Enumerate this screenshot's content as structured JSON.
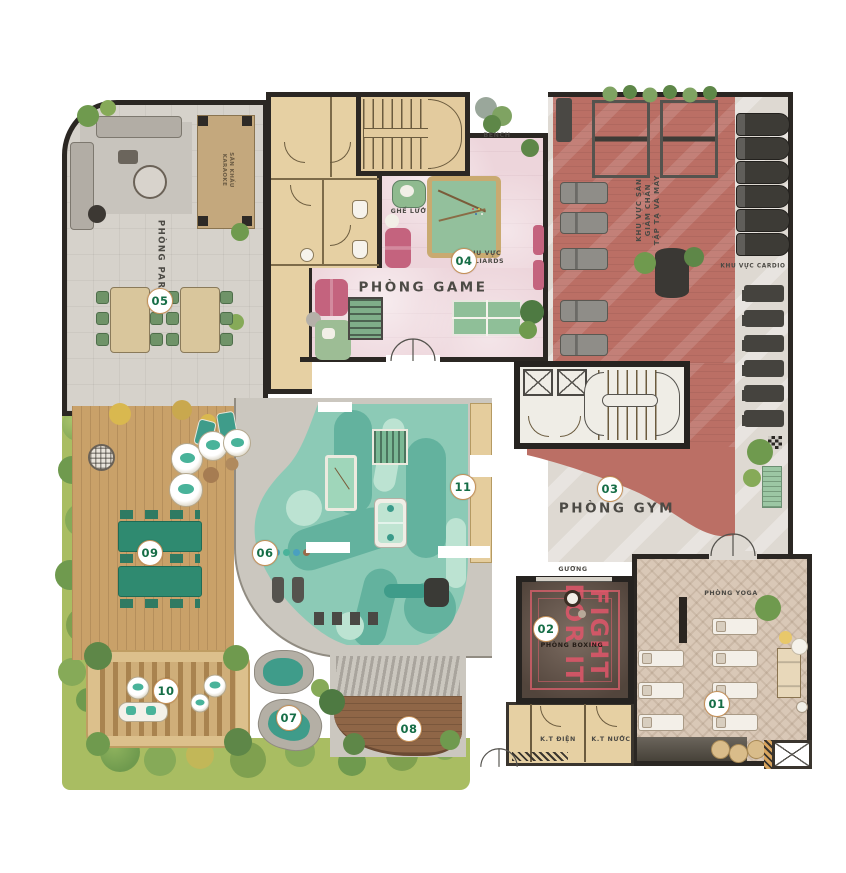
{
  "plan": {
    "markers": [
      {
        "id": "m01",
        "label": "01"
      },
      {
        "id": "m02",
        "label": "02"
      },
      {
        "id": "m03",
        "label": "03"
      },
      {
        "id": "m04",
        "label": "04"
      },
      {
        "id": "m05",
        "label": "05"
      },
      {
        "id": "m06",
        "label": "06"
      },
      {
        "id": "m07",
        "label": "07"
      },
      {
        "id": "m08",
        "label": "08"
      },
      {
        "id": "m09",
        "label": "09"
      },
      {
        "id": "m10",
        "label": "10"
      },
      {
        "id": "m11",
        "label": "11"
      }
    ],
    "labels": {
      "phong_party": "PHÒNG PARTY",
      "san_khau_1": "SÂN KHẤU",
      "san_khau_2": "KARAOKE",
      "ghe_luoi": "GHẾ LƯỚI",
      "billiards_1": "KHU VỰC",
      "billiards_2": "BILLIARDS",
      "phong_game": "PHÒNG GAME",
      "bench": "BENCH",
      "gym_zone_1": "KHU VỰC SÀN",
      "gym_zone_2": "GIẢM CHẤN",
      "gym_zone_3": "TẬP TẠ VÀ MÁY",
      "cardio": "KHU VỰC CARDIO",
      "phong_gym": "PHÒNG GYM",
      "guong": "GƯƠNG",
      "fight_1": "FIGHT",
      "fight_2": "FOR IT",
      "phong_boxing": "PHÒNG BOXING",
      "phong_yoga": "PHÒNG YOGA",
      "kt_dien": "K.T ĐIỆN",
      "kt_nuoc": "K.T NƯỚC"
    },
    "colors": {
      "party_floor": "#d6d2cb",
      "corridor_tan": "#e6d0a3",
      "game_floor": "#edd5db",
      "gym_red": "#bb6f65",
      "gym_light": "#ded9d2",
      "kids_teal": "#8ccab6",
      "kids_teal_dark": "#63b29e",
      "kids_teal_light": "#bce3d2",
      "deck_wood": "#c9a169",
      "boxing_floor": "#6e5c50",
      "yoga_floor": "#d9c8b7",
      "accent_pink": "#e0566a",
      "marker_ring": "#c49058",
      "marker_text": "#156d46",
      "wall": "#2b2723",
      "greenery": "#6f9a4e"
    }
  }
}
